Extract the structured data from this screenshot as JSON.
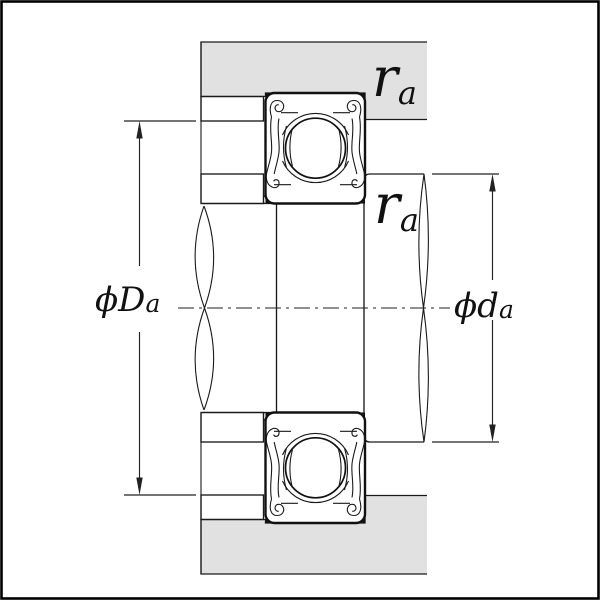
{
  "diagram": {
    "type": "bearing-mounting-cross-section",
    "colors": {
      "background": "#ffffff",
      "housing_fill": "#e1e1e1",
      "shoulder_fill": "#9eb4be",
      "line": "#1a1a1a"
    },
    "labels": {
      "housing_shoulder_diameter": {
        "symbol": "ϕD",
        "subscript": "a"
      },
      "shaft_shoulder_diameter": {
        "symbol": "ϕd",
        "subscript": "a"
      },
      "fillet_radius_housing": {
        "symbol": "r",
        "subscript": "a"
      },
      "fillet_radius_shaft": {
        "symbol": "r",
        "subscript": "a"
      }
    }
  }
}
